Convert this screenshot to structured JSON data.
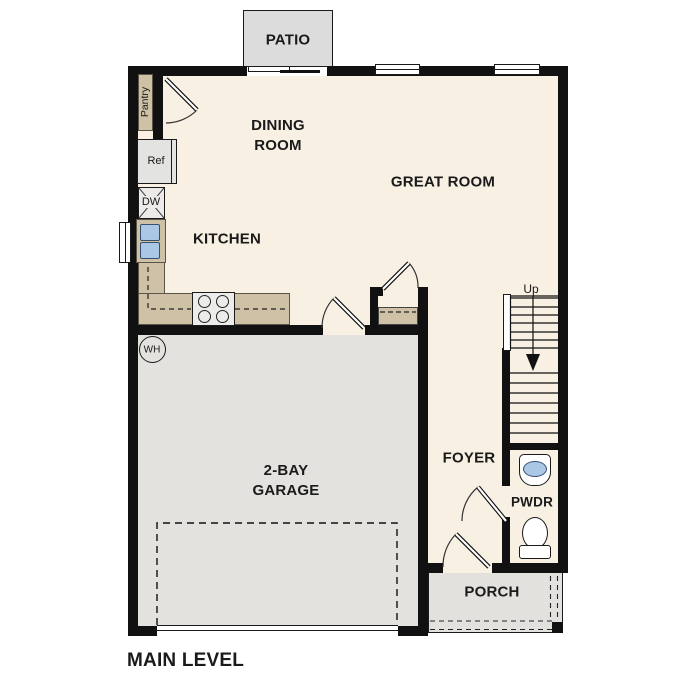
{
  "plan": {
    "title": "MAIN LEVEL",
    "rooms": {
      "patio": "PATIO",
      "dining_room": "DINING ROOM",
      "great_room": "GREAT ROOM",
      "kitchen": "KITCHEN",
      "garage": "2-BAY GARAGE",
      "foyer": "FOYER",
      "powder_room": "PWDR",
      "porch": "PORCH"
    },
    "fixtures": {
      "pantry": "Pantry",
      "refrigerator": "Ref",
      "dishwasher": "DW",
      "water_heater": "WH",
      "stairs_direction": "Up"
    },
    "colors": {
      "wall": "#111111",
      "floor": "#f7f0e3",
      "concrete": "#e4e2df",
      "patio": "#dcdcdc",
      "porch": "#e2e1de",
      "counter": "#cec1a6",
      "blue": "#aac7e6",
      "outline": "#1a1a1a"
    }
  }
}
